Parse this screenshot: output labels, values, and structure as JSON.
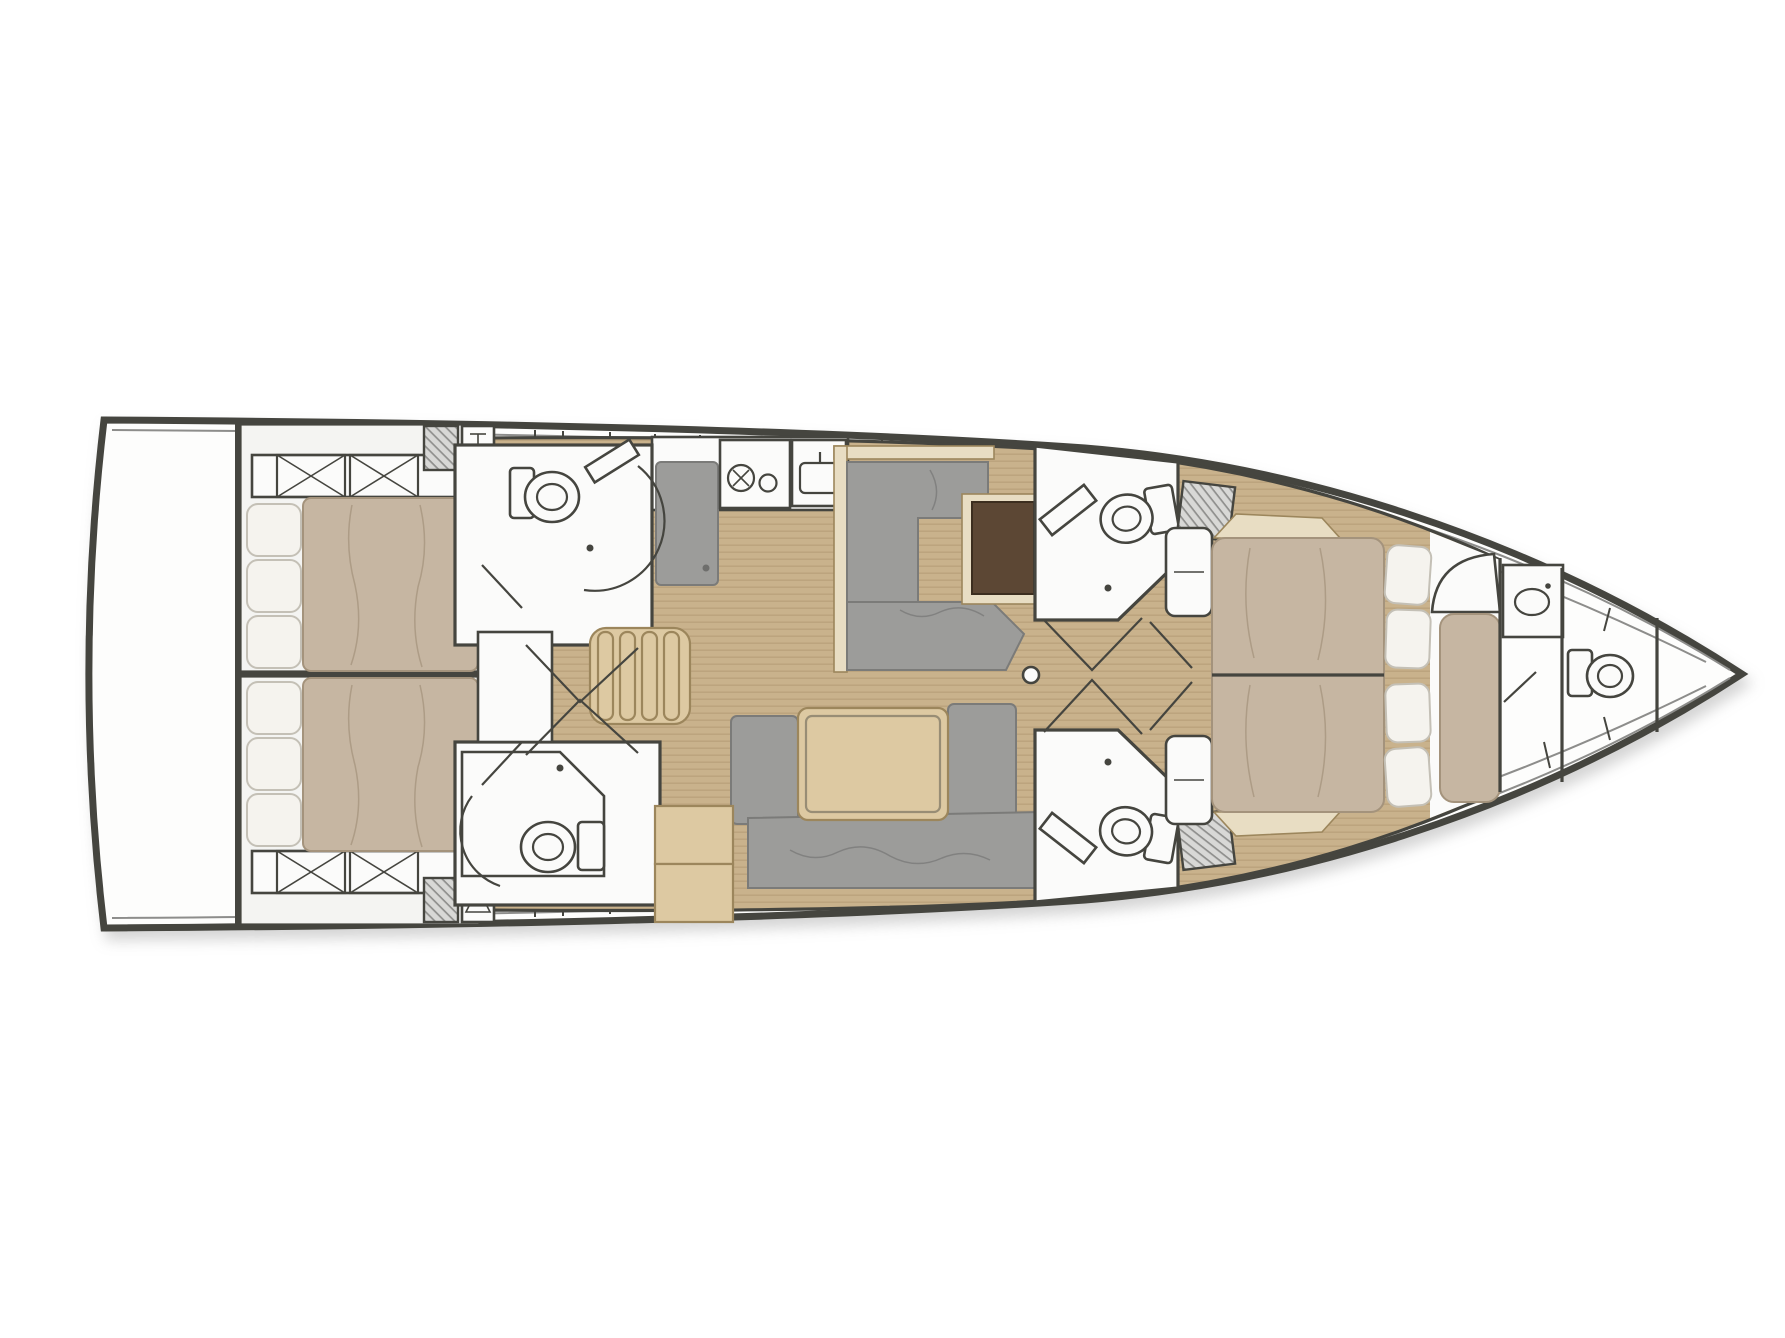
{
  "meta": {
    "kind": "sailing-yacht-interior-floor-plan",
    "orientation": "bow-right",
    "canvas_width": 1785,
    "canvas_height": 1338
  },
  "colors": {
    "line": "#45453f",
    "toeRail": "#8d8d8b",
    "hullFill": "#fdfdfc",
    "cabinFloor": "#f4f4f2",
    "wood": "#c9b28c",
    "woodLine": "#ad946e",
    "furnGray": "#9c9c9a",
    "furnGrayLine": "#7b7b79",
    "mattress": "#c6b6a2",
    "mattressLine": "#a4937c",
    "pillow": "#f5f3ee",
    "pillowLine": "#c4c0b6",
    "lightWood": "#ddc9a2",
    "lightWoodLine": "#9c865c",
    "paleWood": "#e8ddc3",
    "darkWood": "#5c4734",
    "fixture": "#fbfbfa",
    "hatchBg": "#d8d8d6",
    "hatchLine": "#8f8f8d"
  },
  "icons": [
    "double-bed-icon",
    "pillow-icon",
    "toilet-icon",
    "shower-bench-icon",
    "shower-pan-icon",
    "sink-icon",
    "stove-burner-icon",
    "fridge-icon",
    "dining-table-icon",
    "sofa-icon",
    "chart-table-icon",
    "companionway-stairs-icon",
    "hanging-locker-icon",
    "storage-locker-x-icon",
    "mast-icon",
    "door-swing-icon",
    "engine-hatch-icon"
  ]
}
